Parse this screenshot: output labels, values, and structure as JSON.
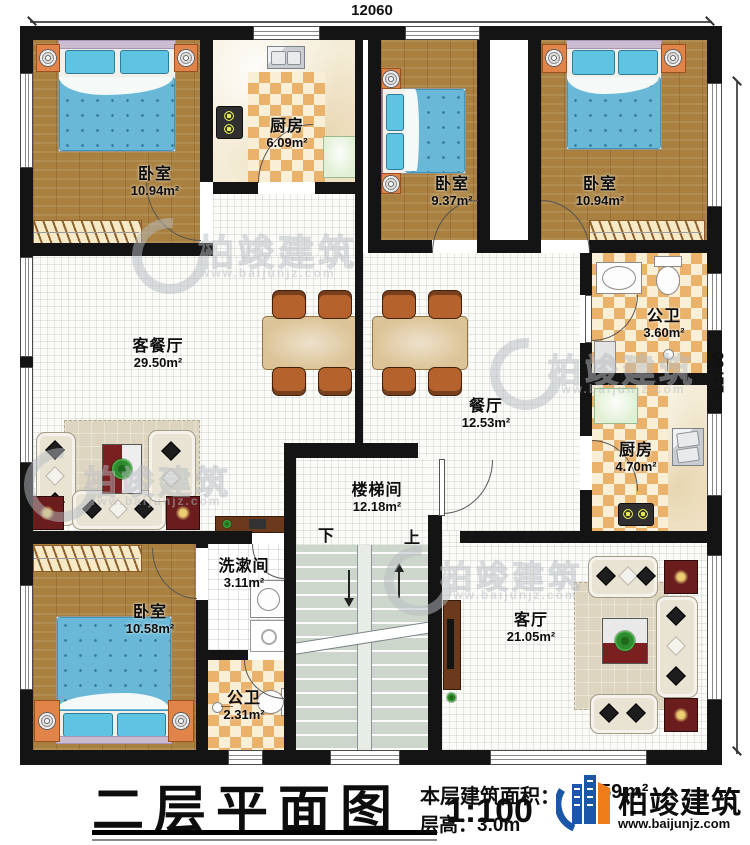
{
  "dimensions": {
    "top": "12060",
    "right": "12760"
  },
  "rooms": [
    {
      "label": "卧室",
      "area": "10.94m²"
    },
    {
      "label": "厨房",
      "area": "6.09m²"
    },
    {
      "label": "卧室",
      "area": "9.37m²"
    },
    {
      "label": "卧室",
      "area": "10.94m²"
    },
    {
      "label": "公卫",
      "area": "3.60m²"
    },
    {
      "label": "厨房",
      "area": "4.70m²"
    },
    {
      "label": "客餐厅",
      "area": "29.50m²"
    },
    {
      "label": "餐厅",
      "area": "12.53m²"
    },
    {
      "label": "楼梯间",
      "area": "12.18m²"
    },
    {
      "label": "洗漱间",
      "area": "3.11m²"
    },
    {
      "label": "公卫",
      "area": "2.31m²"
    },
    {
      "label": "卧室",
      "area": "10.58m²"
    },
    {
      "label": "客厅",
      "area": "21.05m²"
    }
  ],
  "stairs": {
    "down": "下",
    "up": "上"
  },
  "title_block": {
    "title": "二层平面图",
    "scale": "1:100",
    "area_label": "本层建筑面积：",
    "area_value": "59",
    "area_unit": "m²",
    "floor_height": "层高：3.0m"
  },
  "brand": {
    "name": "柏竣建筑",
    "url": "www.baijunjz.com",
    "blue": "#1a57a8",
    "orange": "#ef7d1a"
  }
}
